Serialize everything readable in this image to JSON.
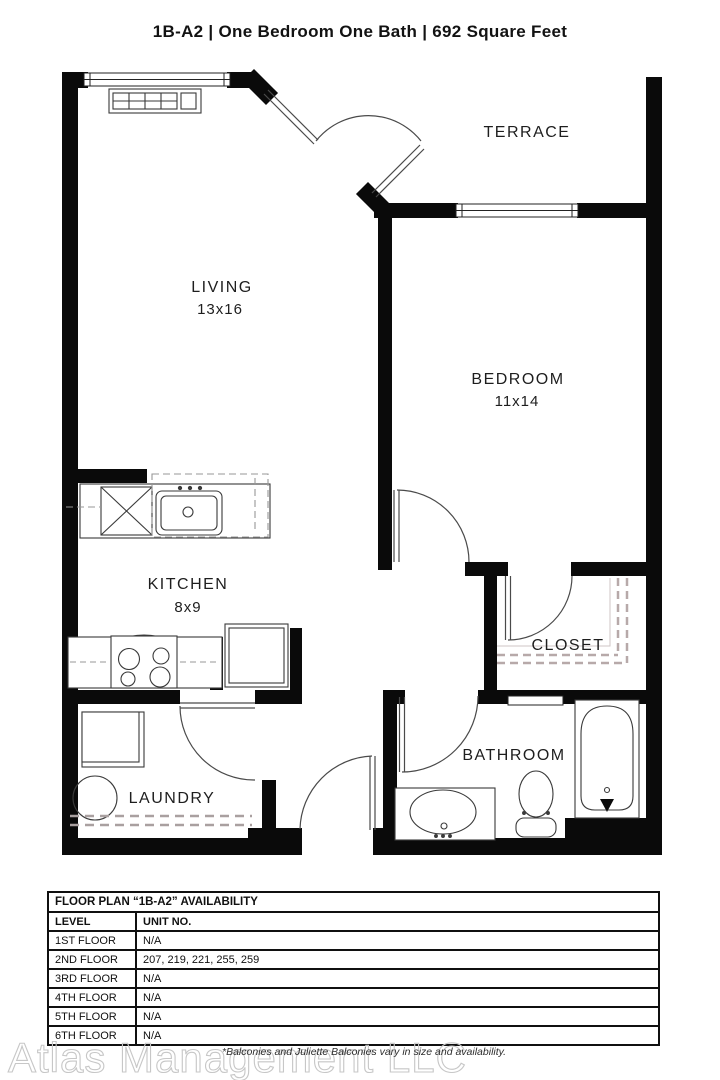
{
  "title": {
    "text": "1B-A2  |  One Bedroom One Bath  |  692 Square Feet"
  },
  "floor_plan": {
    "rooms": [
      {
        "name": "TERRACE",
        "dims": ""
      },
      {
        "name": "LIVING",
        "dims": "13x16"
      },
      {
        "name": "BEDROOM",
        "dims": "11x14"
      },
      {
        "name": "KITCHEN",
        "dims": "8x9"
      },
      {
        "name": "CLOSET",
        "dims": ""
      },
      {
        "name": "BATHROOM",
        "dims": ""
      },
      {
        "name": "LAUNDRY",
        "dims": ""
      }
    ]
  },
  "availability_table": {
    "title": "FLOOR PLAN “1B-A2” AVAILABILITY",
    "columns": [
      "LEVEL",
      "UNIT NO."
    ],
    "rows": [
      {
        "level": "1ST FLOOR",
        "units": "N/A"
      },
      {
        "level": "2ND FLOOR",
        "units": "207, 219, 221, 255, 259"
      },
      {
        "level": "3RD FLOOR",
        "units": "N/A"
      },
      {
        "level": "4TH FLOOR",
        "units": "N/A"
      },
      {
        "level": "5TH FLOOR",
        "units": "N/A"
      },
      {
        "level": "6TH FLOOR",
        "units": "N/A"
      }
    ]
  },
  "footer": {
    "watermark": "Atlas Management LLC",
    "disclaimer": "*Balconies and Juliette Balconies vary in size and availability."
  },
  "colors": {
    "wall": "#0a0a0a",
    "fixture_line": "#3a3a3a",
    "closet_dash": "#b7a9a9",
    "kitchen_dash": "#979797",
    "watermark_gray": "#c7c7c7"
  }
}
